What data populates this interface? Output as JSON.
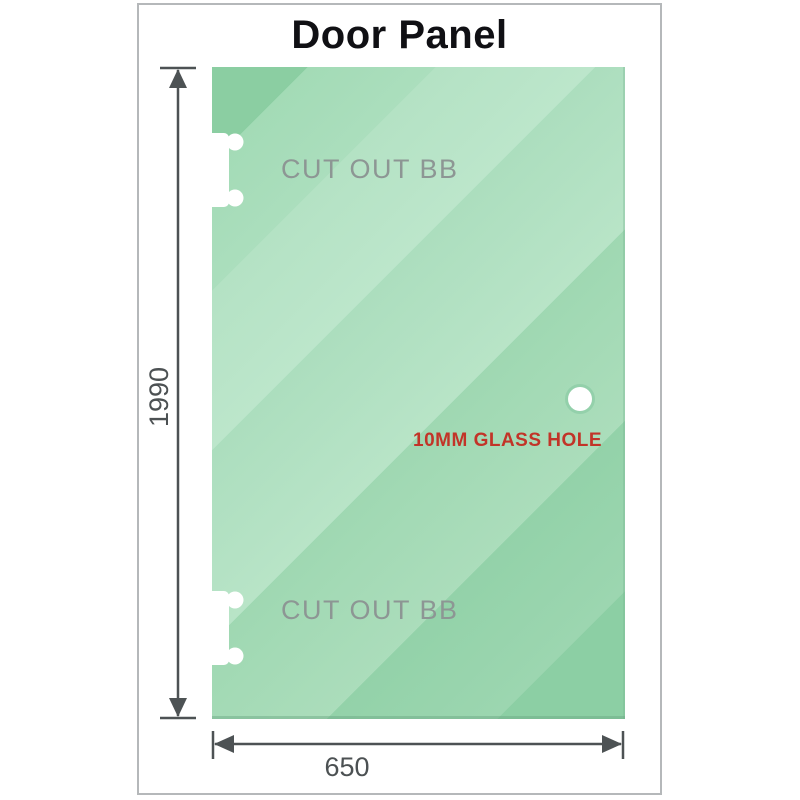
{
  "title": "Door Panel",
  "panel": {
    "cutout_top": {
      "label": "CUT OUT BB"
    },
    "cutout_bottom": {
      "label": "CUT OUT BB"
    },
    "glass_hole": {
      "label": "10MM GLASS HOLE"
    }
  },
  "dimensions": {
    "height": {
      "value": "1990"
    },
    "width": {
      "value": "650"
    }
  },
  "colors": {
    "glass_green": "#9bd4af",
    "glass_green_light": "#bce6cb",
    "hole_label_red": "#c23428",
    "dimension_gray": "#4d5254",
    "cutout_label_gray": "#8d9694",
    "frame_border_gray": "#b5b8ba"
  }
}
